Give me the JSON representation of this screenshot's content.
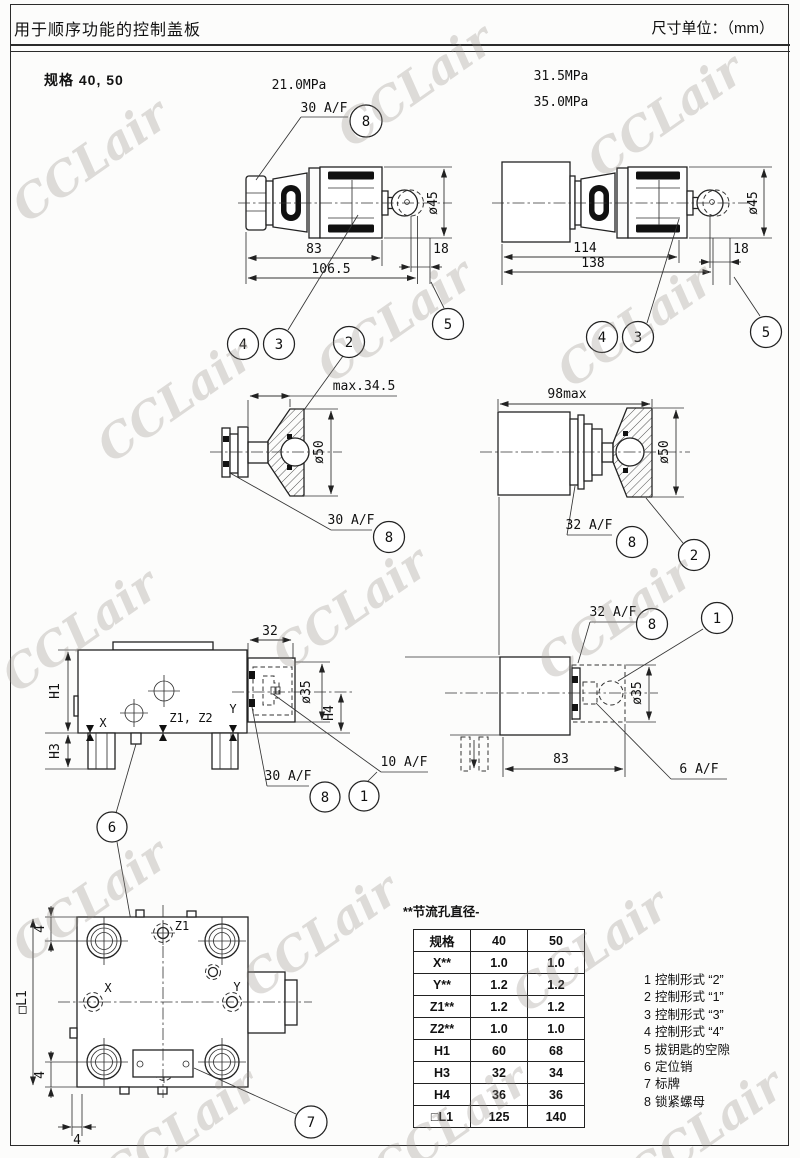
{
  "page": {
    "title": "用于顺序功能的控制盖板",
    "units": "尺寸单位：（mm）",
    "spec": "规格 40, 50",
    "watermark": "CCLair"
  },
  "pressures": {
    "p21": "21.0MPa",
    "p315": "31.5MPa",
    "p350": "35.0MPa"
  },
  "labels": {
    "wrench30": "30 A/F",
    "wrench32": "32 A/F",
    "wrench10": "10 A/F",
    "wrench6": "6 A/F",
    "dia45": "ø45",
    "dia50": "ø50",
    "dia35": "ø35",
    "max345": "max.34.5",
    "max98": "98max",
    "d83": "83",
    "d1065": "106.5",
    "d18": "18",
    "d114": "114",
    "d138": "138",
    "d32": "32",
    "d4": "4",
    "h1": "H1",
    "h3": "H3",
    "h4": "H4",
    "l1": "□L1",
    "portX": "X",
    "portY": "Y",
    "portZ1": "Z1",
    "portZ2": "Z2",
    "portZ12": "Z1, Z2"
  },
  "balloons": {
    "b1": "1",
    "b2": "2",
    "b3": "3",
    "b4": "4",
    "b5": "5",
    "b6": "6",
    "b7": "7",
    "b8": "8"
  },
  "table": {
    "note": "**节流孔直径-",
    "headers": [
      "规格",
      "40",
      "50"
    ],
    "rows": [
      [
        "X**",
        "1.0",
        "1.0"
      ],
      [
        "Y**",
        "1.2",
        "1.2"
      ],
      [
        "Z1**",
        "1.2",
        "1.2"
      ],
      [
        "Z2**",
        "1.0",
        "1.0"
      ],
      [
        "H1",
        "60",
        "68"
      ],
      [
        "H3",
        "32",
        "34"
      ],
      [
        "H4",
        "36",
        "36"
      ],
      [
        "□L1",
        "125",
        "140"
      ]
    ]
  },
  "legend": {
    "items": [
      {
        "num": "1",
        "text": "控制形式 “2”"
      },
      {
        "num": "2",
        "text": "控制形式 “1”"
      },
      {
        "num": "3",
        "text": "控制形式 “3”"
      },
      {
        "num": "4",
        "text": "控制形式 “4”"
      },
      {
        "num": "5",
        "text": "拔钥匙的空隙"
      },
      {
        "num": "6",
        "text": "定位销"
      },
      {
        "num": "7",
        "text": "标牌"
      },
      {
        "num": "8",
        "text": "锁紧螺母"
      }
    ]
  }
}
